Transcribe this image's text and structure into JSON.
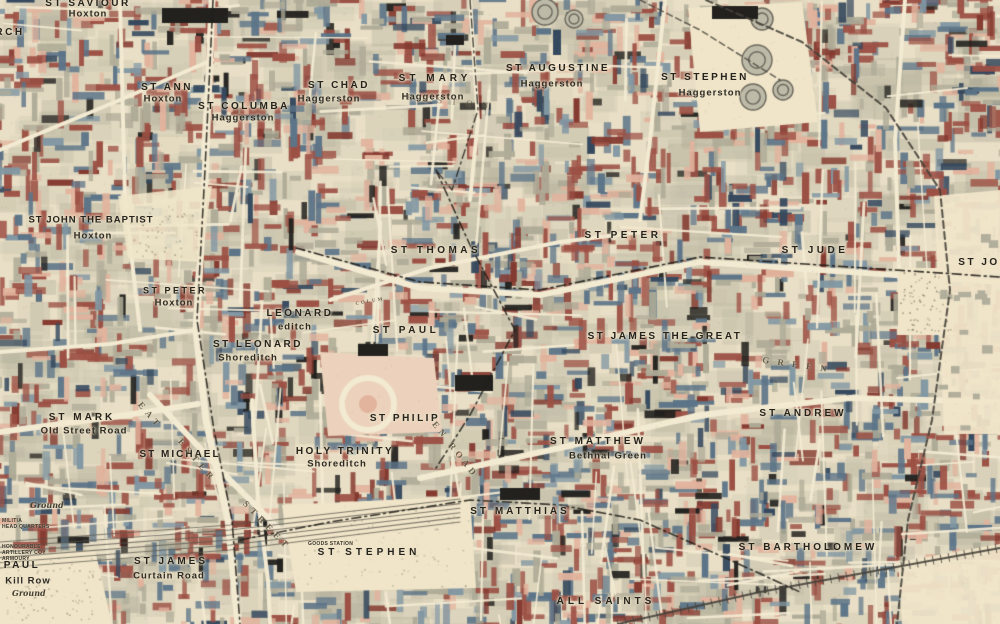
{
  "map": {
    "kind": "historical poverty map",
    "area_labels_note": "parish names over Shoreditch, Hoxton, Haggerston and Bethnal Green"
  },
  "palette": {
    "paper": "#e9dfc6",
    "street": "#f3ead2",
    "open": "#f0e5c9",
    "pink": "#e2b39d",
    "light_pink": "#ecd2bc",
    "red": "#9c5044",
    "dark_red": "#84392f",
    "light_blue": "#8197a3",
    "blue": "#5c7488",
    "dark_blue": "#35495e",
    "black": "#22211e",
    "gray_green": "#aeab97",
    "ink": "#201d18",
    "rail": "#45413a"
  },
  "labels": {
    "parishes": [
      {
        "text": "ST SAVIOUR",
        "x": 88,
        "y": 4,
        "sub": "Hoxton",
        "sx": 88,
        "sy": 14
      },
      {
        "text": "ST ANN",
        "x": 167,
        "y": 88,
        "sub": "Hoxton",
        "sx": 163,
        "sy": 99
      },
      {
        "text": "ST COLUMBA",
        "x": 244,
        "y": 107,
        "sub": "Haggerston",
        "sx": 243,
        "sy": 118
      },
      {
        "text": "ST CHAD",
        "x": 339,
        "y": 86,
        "sub": "Haggerston",
        "sx": 329,
        "sy": 99
      },
      {
        "text": "ST MARY",
        "x": 435,
        "y": 79,
        "sub": "Haggerston",
        "sx": 433,
        "sy": 97,
        "track": 4
      },
      {
        "text": "ST AUGUSTINE",
        "x": 558,
        "y": 69,
        "sub": "Haggerston",
        "sx": 552,
        "sy": 84
      },
      {
        "text": "ST STEPHEN",
        "x": 705,
        "y": 78,
        "sub": "Haggerston",
        "sx": 710,
        "sy": 93
      },
      {
        "text": "ST JOHN THE BAPTIST",
        "x": 91,
        "y": 220,
        "sub": "Hoxton",
        "sx": 93,
        "sy": 236,
        "fs": 9.5,
        "track": 1
      },
      {
        "text": "ST THOMAS",
        "x": 436,
        "y": 251,
        "track": 3.5
      },
      {
        "text": "ST PETER",
        "x": 623,
        "y": 236,
        "track": 3.5
      },
      {
        "text": "ST JUDE",
        "x": 815,
        "y": 251,
        "track": 3.5
      },
      {
        "text": "ST PETER",
        "x": 175,
        "y": 291,
        "sub": "Hoxton",
        "sx": 174,
        "sy": 303,
        "fs": 9
      },
      {
        "text": "LEONARD",
        "x": 300,
        "y": 314,
        "sub": "editch",
        "sx": 295,
        "sy": 327
      },
      {
        "text": "ST LEONARD",
        "x": 258,
        "y": 345,
        "sub": "Shoreditch",
        "sx": 248,
        "sy": 358
      },
      {
        "text": "ST PAUL",
        "x": 406,
        "y": 331,
        "track": 3.5
      },
      {
        "text": "ST JAMES THE GREAT",
        "x": 665,
        "y": 337,
        "track": 2.5
      },
      {
        "text": "ST MARK",
        "x": 82,
        "y": 418,
        "sub": "Old Street Road",
        "sx": 84,
        "sy": 431,
        "track": 3
      },
      {
        "text": "ST PHILIP",
        "x": 405,
        "y": 419,
        "track": 2.5
      },
      {
        "text": "ST ANDREW",
        "x": 803,
        "y": 414,
        "track": 3
      },
      {
        "text": "ST MICHAEL",
        "x": 180,
        "y": 455,
        "track": 2
      },
      {
        "text": "HOLY TRINITY",
        "x": 345,
        "y": 452,
        "sub": "Shoreditch",
        "sx": 337,
        "sy": 464
      },
      {
        "text": "ST MATTHEW",
        "x": 598,
        "y": 442,
        "sub": "Bethnal Green",
        "sx": 608,
        "sy": 456,
        "track": 3
      },
      {
        "text": "ST MATTHIAS",
        "x": 520,
        "y": 512,
        "track": 3
      },
      {
        "text": "ST STEPHEN",
        "x": 369,
        "y": 553,
        "track": 4
      },
      {
        "text": "ST BARTHOLOMEW",
        "x": 808,
        "y": 548,
        "track": 3
      },
      {
        "text": "ST JAMES",
        "x": 171,
        "y": 562,
        "sub": "Curtain Road",
        "sx": 169,
        "sy": 576,
        "track": 3
      },
      {
        "text": "PAUL",
        "x": 22,
        "y": 566,
        "sub": "Kill Row",
        "sx": 28,
        "sy": 581
      },
      {
        "text": "ALL SAINTS",
        "x": 606,
        "y": 602,
        "track": 4
      }
    ],
    "fragments": [
      {
        "text": "RCH",
        "x": 10,
        "y": 33
      },
      {
        "text": "ST JO",
        "x": 979,
        "y": 263
      }
    ],
    "streets": [
      {
        "text": "EAT",
        "x": 150,
        "y": 416,
        "angle": 50,
        "track": 5
      },
      {
        "text": "ESTER",
        "x": 197,
        "y": 461,
        "angle": 50,
        "track": 5
      },
      {
        "text": "STREET",
        "x": 267,
        "y": 526,
        "angle": 46,
        "track": 5
      },
      {
        "text": "EN ROAD",
        "x": 455,
        "y": 450,
        "angle": 52,
        "track": 4
      },
      {
        "text": "G R E E N",
        "x": 796,
        "y": 365,
        "angle": 8,
        "track": 3
      },
      {
        "text": "COLUM",
        "x": 370,
        "y": 302,
        "angle": -10,
        "fs": 5,
        "track": 2
      },
      {
        "text": "ERSTON",
        "x": 452,
        "y": 102,
        "angle": 6,
        "track": 9,
        "faint": true
      }
    ],
    "small": [
      {
        "text": "GOODS STATION",
        "x": 308,
        "y": 541
      },
      {
        "text": "MILITIA",
        "x": 2,
        "y": 518
      },
      {
        "text": "HEAD QUARTERS",
        "x": 2,
        "y": 524
      },
      {
        "text": "HONOURABLE",
        "x": 2,
        "y": 544
      },
      {
        "text": "ARTILLERY COY",
        "x": 2,
        "y": 550
      },
      {
        "text": "ARMOURY",
        "x": 2,
        "y": 556
      }
    ],
    "script": [
      {
        "text": "Ground",
        "x": 12,
        "y": 589
      },
      {
        "text": "Ground",
        "x": 30,
        "y": 501
      }
    ]
  }
}
